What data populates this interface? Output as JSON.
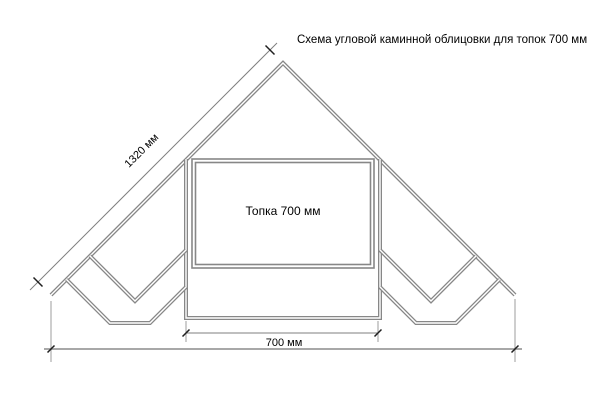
{
  "title": "Схема угловой каминной облицовки для топок 700 мм",
  "firebox": {
    "label": "Топка 700 мм"
  },
  "dimensions": {
    "diagonal_length": "1320 мм",
    "firebox_width": "700 мм"
  },
  "colors": {
    "structure": "#878787",
    "dimension": "#7f7f7f",
    "dimension-light": "#9c9c9c",
    "tick": "#1f1f1f",
    "text": "#000000",
    "background": "#ffffff"
  }
}
